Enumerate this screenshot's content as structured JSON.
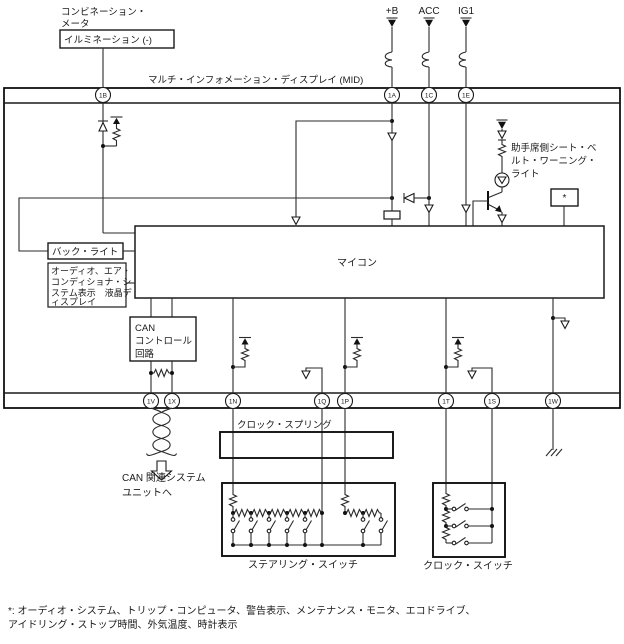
{
  "title": "マルチ・インフォメーション・ディスプレイ (MID)",
  "colors": {
    "line": "#1a1a1a",
    "background": "#ffffff"
  },
  "external": {
    "combination_meter_label": [
      "コンビネーション・",
      "メータ"
    ],
    "illumination_box": "イルミネーション (-)",
    "power_labels": [
      "+B",
      "ACC",
      "IG1"
    ]
  },
  "connectors": {
    "top": [
      "1B",
      "1A",
      "1C",
      "1E"
    ],
    "bottom": [
      "1V",
      "1X",
      "1N",
      "1Q",
      "1P",
      "1T",
      "1S",
      "1W"
    ]
  },
  "internal": {
    "micom_label": "マイコン",
    "backlight_label": "バック・ライト",
    "lcd_label": [
      "オーディオ、エア・",
      "コンディショナ・シ",
      "ステム表示　液晶デ",
      "ィスプレイ"
    ],
    "can_label": [
      "CAN",
      "コントロール",
      "回路"
    ],
    "asterisk_label": "*"
  },
  "seatbelt_light_label": [
    "助手席側シート・ベ",
    "ルト・ワーニング・",
    "ライト"
  ],
  "lower": {
    "can_destination": [
      "CAN 関連システム",
      "ユニットへ"
    ],
    "clock_spring_label": "クロック・スプリング",
    "steering_switch_label": "ステアリング・スイッチ",
    "clock_switch_label": "クロック・スイッチ"
  },
  "footnote": [
    "*: オーディオ・システム、トリップ・コンピュータ、警告表示、メンテナンス・モニタ、エコドライブ、",
    "アイドリング・ストップ時間、外気温度、時計表示"
  ]
}
